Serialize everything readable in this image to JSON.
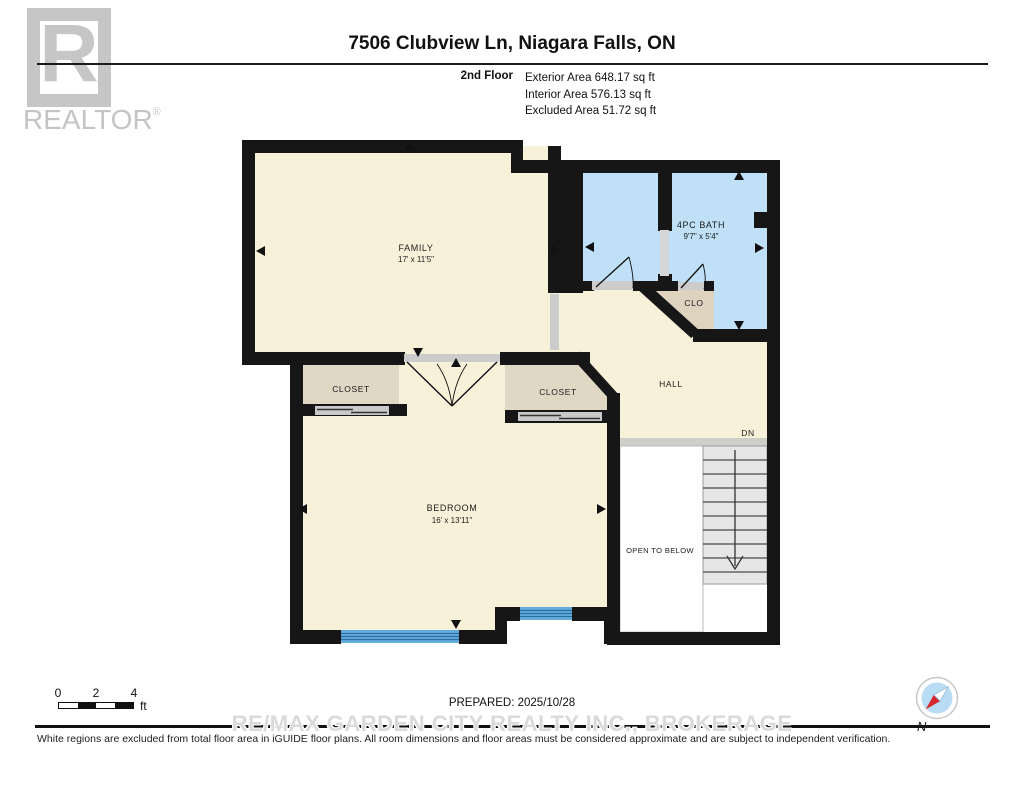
{
  "header": {
    "logo_letter": "R",
    "logo_word": "REALTOR",
    "logo_reg": "®",
    "title": "7506 Clubview Ln, Niagara Falls, ON",
    "floor_label": "2nd Floor",
    "stats": [
      "Exterior Area 648.17 sq ft",
      "Interior Area 576.13 sq ft",
      "Excluded Area 51.72 sq ft"
    ]
  },
  "plan": {
    "rooms": {
      "family": {
        "name": "FAMILY",
        "dims": "17' x 11'5\""
      },
      "bath": {
        "name": "4PC BATH",
        "dims": "9'7\" x 5'4\""
      },
      "clo": {
        "name": "CLO"
      },
      "closet_left": {
        "name": "CLOSET"
      },
      "closet_right": {
        "name": "CLOSET"
      },
      "hall": {
        "name": "HALL"
      },
      "bedroom": {
        "name": "BEDROOM",
        "dims": "16' x 13'11\""
      },
      "stairs_label": "DN",
      "open_below": "OPEN TO BELOW"
    },
    "colors": {
      "room_cream": "#f8f1da",
      "room_blue": "#bfe0f6",
      "room_tan": "#e0d7c5",
      "wall": "#161616",
      "window_blue": "#63adde",
      "stairs_gray": "#e6e6e6"
    }
  },
  "footer": {
    "scale": {
      "t0": "0",
      "t2": "2",
      "t4": "4",
      "unit": "ft"
    },
    "prepared": "PREPARED: 2025/10/28",
    "watermark": "RE/MAX GARDEN CITY REALTY INC., BROKERAGE",
    "disclaimer": "White regions are excluded from total floor area in iGUIDE floor plans. All room dimensions and floor areas must be considered approximate and are subject to independent verification.",
    "compass_n": "N"
  }
}
